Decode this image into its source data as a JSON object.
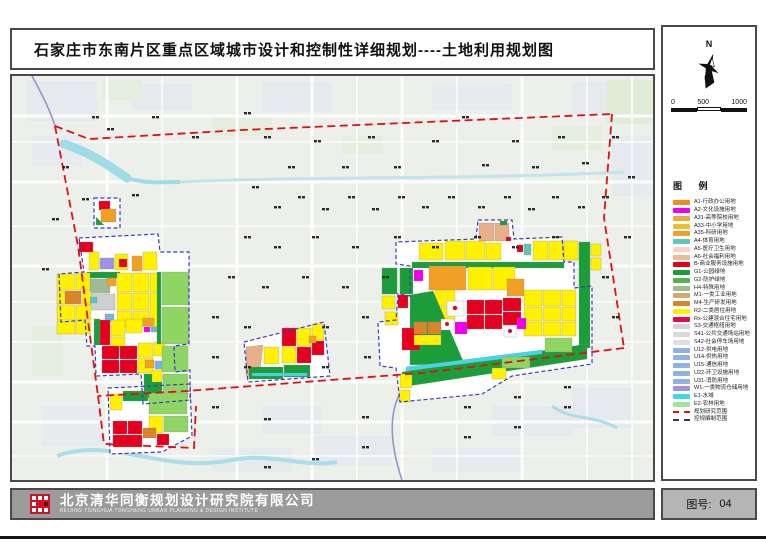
{
  "sheet": {
    "title": "石家庄市东南片区重点区域城市设计和控制性详细规划----土地利用规划图",
    "sheet_no_label": "图号:",
    "sheet_no_value": "04"
  },
  "compass": {
    "north_label": "N"
  },
  "scale_bar": {
    "ticks": [
      "0",
      "500",
      "1000"
    ]
  },
  "legend": {
    "title": "图 例",
    "items": [
      {
        "code": "A1",
        "label": "A1-行政办公用地",
        "color": "#F08C1E",
        "type": "fill"
      },
      {
        "code": "A2",
        "label": "A2-文化设施用地",
        "color": "#EE00EE",
        "type": "fill"
      },
      {
        "code": "A31",
        "label": "A31-高等院校用地",
        "color": "#EFA93B",
        "type": "fill"
      },
      {
        "code": "A33",
        "label": "A33-中小学用地",
        "color": "#EFBD2F",
        "type": "fill"
      },
      {
        "code": "A35",
        "label": "A35-科研用地",
        "color": "#F0A125",
        "type": "fill"
      },
      {
        "code": "A4",
        "label": "A4-体育用地",
        "color": "#5BC8BC",
        "type": "fill"
      },
      {
        "code": "A5",
        "label": "A5-医疗卫生用地",
        "color": "#F9D3CB",
        "type": "fill"
      },
      {
        "code": "A6",
        "label": "A6-社会福利用地",
        "color": "#F4B98F",
        "type": "fill"
      },
      {
        "code": "B",
        "label": "B-商业服务设施用地",
        "color": "#E60020",
        "type": "fill"
      },
      {
        "code": "G1",
        "label": "G1-公园绿地",
        "color": "#1B9E3A",
        "type": "fill"
      },
      {
        "code": "G2",
        "label": "G2-防护绿地",
        "color": "#55B54A",
        "type": "fill"
      },
      {
        "code": "H4",
        "label": "H4-特殊用地",
        "color": "#9EBB95",
        "type": "fill"
      },
      {
        "code": "M1",
        "label": "M1-一类工业用地",
        "color": "#D2A878",
        "type": "fill"
      },
      {
        "code": "M4",
        "label": "M4-生产研发用地",
        "color": "#D98428",
        "type": "fill"
      },
      {
        "code": "R2",
        "label": "R2-二类居住用地",
        "color": "#FFF100",
        "type": "fill"
      },
      {
        "code": "Rx",
        "label": "Rx-公建混合住宅用地",
        "color": "#E60A4F",
        "type": "fill"
      },
      {
        "code": "S3",
        "label": "S3-交通枢纽用地",
        "color": "#D5D5D5",
        "type": "fill"
      },
      {
        "code": "S41",
        "label": "S41-公共交通场站用地",
        "color": "#DADADA",
        "type": "fill"
      },
      {
        "code": "S42",
        "label": "S42-社会停车场用地",
        "color": "#DFDFDF",
        "type": "fill"
      },
      {
        "code": "U12",
        "label": "U12-供电用地",
        "color": "#8FB2E2",
        "type": "fill"
      },
      {
        "code": "U14",
        "label": "U14-供热用地",
        "color": "#8FB2E2",
        "type": "fill"
      },
      {
        "code": "U15",
        "label": "U15-通信用地",
        "color": "#8FB2E2",
        "type": "fill"
      },
      {
        "code": "U22",
        "label": "U22-环卫设施用地",
        "color": "#8FB2E2",
        "type": "fill"
      },
      {
        "code": "U31",
        "label": "U31-消防用地",
        "color": "#8FB2E2",
        "type": "fill"
      },
      {
        "code": "W1",
        "label": "W1-一类物流仓储用地",
        "color": "#9E92E2",
        "type": "fill"
      },
      {
        "code": "E1",
        "label": "E1-水域",
        "color": "#3ED9E9",
        "type": "fill"
      },
      {
        "code": "E2",
        "label": "E2-农林用地",
        "color": "#A3E396",
        "type": "fill"
      },
      {
        "code": "boundary-research",
        "label": "规划研究范围",
        "color": "#E01010",
        "type": "line"
      },
      {
        "code": "boundary-regulatory",
        "label": "控规编制范围",
        "color": "#333366",
        "type": "line"
      }
    ]
  },
  "footer": {
    "company_cn": "北京清华同衡规划设计研究院有限公司",
    "company_en": "BEIJING TSINGHUA TONGHENG URBAN PLANNING & DESIGN INSTITUTE"
  },
  "map": {
    "base_color": "#EDF0EA",
    "road_color": "#FFFFFF",
    "water_color": "#9FDCE8",
    "research_boundary_color": "#E01010",
    "regulatory_boundary_color": "#3A3AC0"
  }
}
